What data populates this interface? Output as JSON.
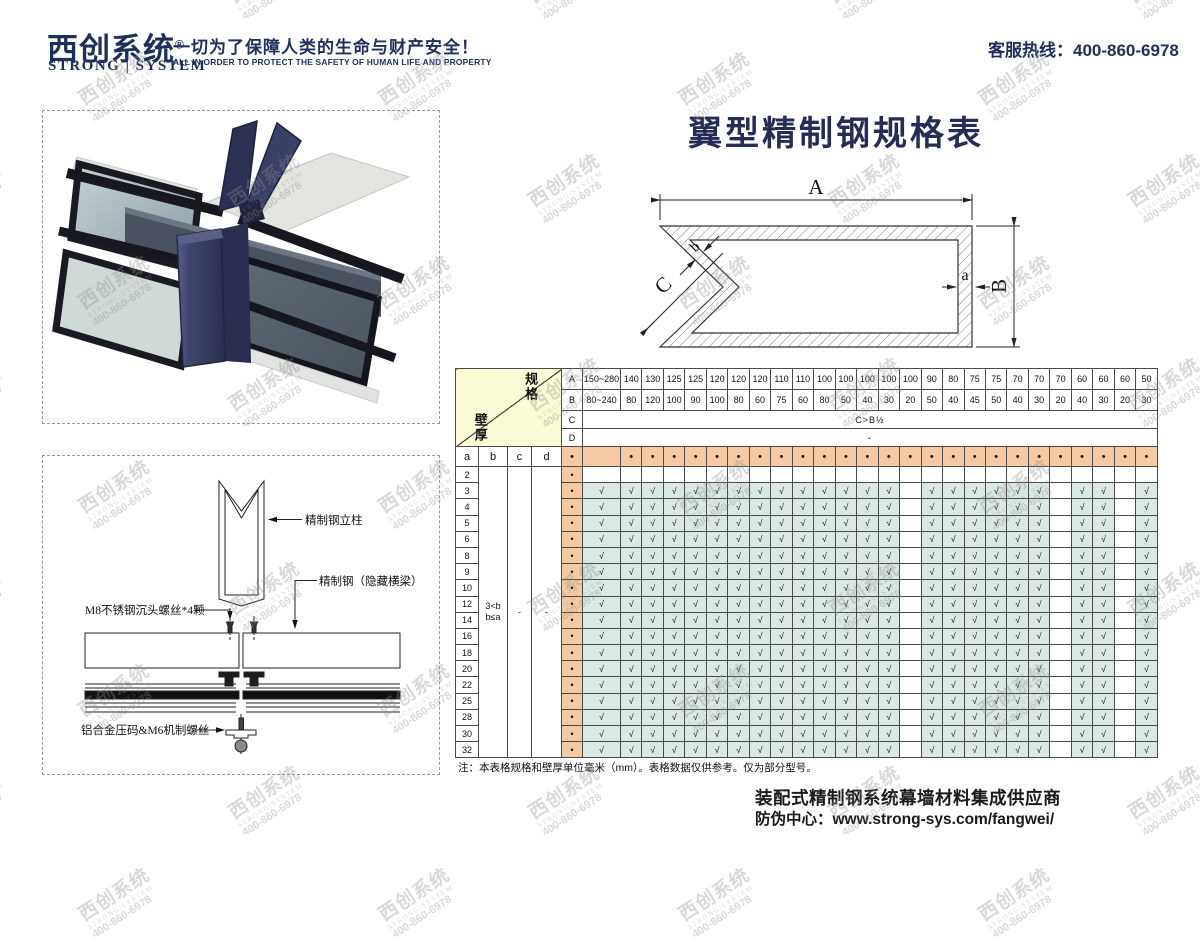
{
  "header": {
    "logo_cn": "西创系统",
    "logo_reg": "®",
    "logo_en": "STRONG | SYSTEM",
    "slogan_cn": "一切为了保障人类的生命与财产安全！",
    "slogan_en": "ALL IN ORDER TO PROTECT THE SAFETY OF HUMAN LIFE AND PROPERTY",
    "hotline": "客服热线：400-860-6978"
  },
  "watermark": {
    "line1": "西创系统",
    "line2": "STRONG|SYSTEM",
    "line3": "400-860-6978"
  },
  "title": "翼型精制钢规格表",
  "diagram": {
    "dim_A": "A",
    "dim_B": "B",
    "dim_C": "C",
    "dim_a": "a",
    "dim_b": "b"
  },
  "drawing_labels": {
    "column": "精制钢立柱",
    "beam": "精制钢（隐藏横梁）",
    "screw": "M8不锈钢沉头螺丝*4颗",
    "clamp": "铝合金压码&M6机制螺丝"
  },
  "spec_table": {
    "corner_top": "规格",
    "corner_bottom": "壁厚",
    "row_labels": [
      "A",
      "B",
      "C",
      "D"
    ],
    "col_A": [
      "150~280",
      "140",
      "130",
      "125",
      "125",
      "120",
      "120",
      "120",
      "110",
      "110",
      "100",
      "100",
      "100",
      "100",
      "100",
      "90",
      "80",
      "75",
      "75",
      "70",
      "70",
      "70",
      "60",
      "60",
      "60",
      "50"
    ],
    "col_B": [
      "80~240",
      "80",
      "120",
      "100",
      "90",
      "100",
      "80",
      "60",
      "75",
      "60",
      "80",
      "50",
      "40",
      "30",
      "20",
      "50",
      "40",
      "45",
      "50",
      "40",
      "30",
      "20",
      "40",
      "30",
      "20",
      "30"
    ],
    "row_C_text": "C>B½",
    "row_D_text": "-",
    "thickness_headers": [
      "a",
      "b",
      "c",
      "d"
    ],
    "marker": "•",
    "check": "√",
    "b_constraint": [
      "3<b",
      "b≤a"
    ],
    "c_value": "-",
    "d_value": "-",
    "a_values": [
      "2",
      "3",
      "4",
      "5",
      "6",
      "8",
      "9",
      "10",
      "12",
      "14",
      "16",
      "18",
      "20",
      "22",
      "25",
      "28",
      "30",
      "32"
    ],
    "empty_row_a": "2",
    "no_check_cols": [
      14,
      21,
      24
    ],
    "note": "注：本表格规格和壁厚单位毫米（mm）。表格数据仅供参考。仅为部分型号。"
  },
  "footer": {
    "line1": "装配式精制钢系统幕墙材料集成供应商",
    "line2": "防伪中心：www.strong-sys.com/fangwei/"
  },
  "colors": {
    "brand_navy": "#1e2f5c",
    "title_navy": "#252d56",
    "table_orange": "#f5c9a2",
    "table_teal": "#d9e8e2",
    "table_yellow": "#fbfbd6",
    "table_border": "#4a4a4a",
    "mullion_navy": "#3a4066",
    "watermark_gray": "#8f8f8f"
  }
}
